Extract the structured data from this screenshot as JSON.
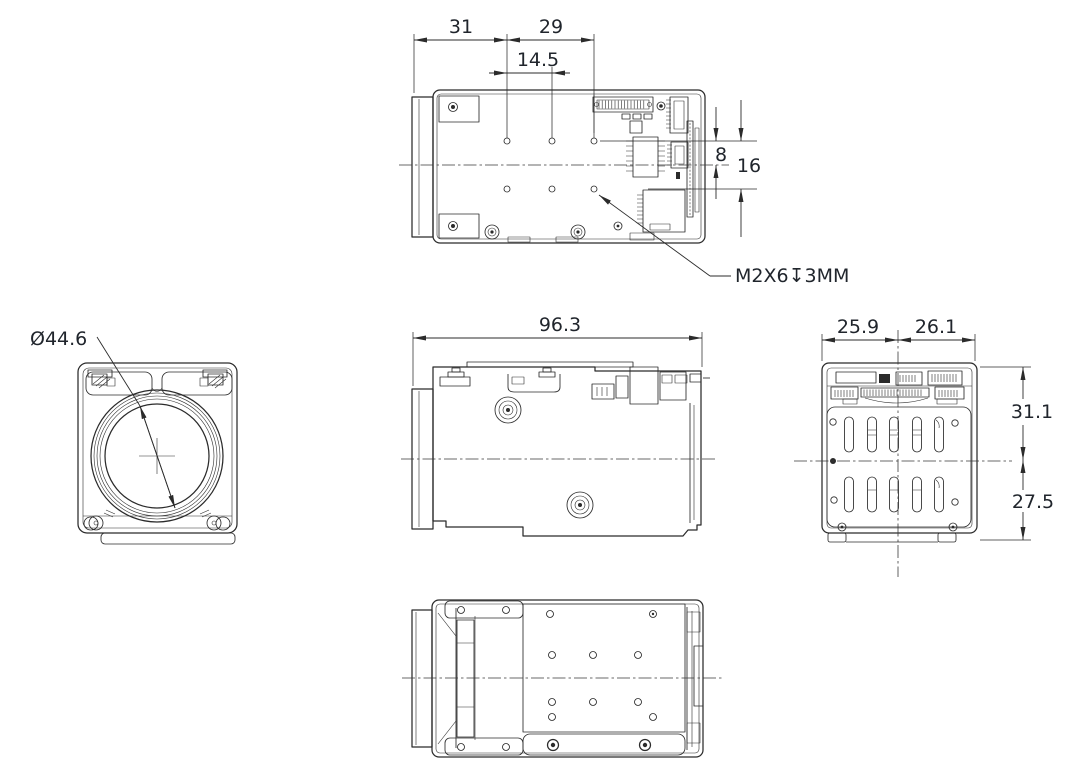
{
  "drawing": {
    "colors": {
      "background": "#ffffff",
      "line": "#2b2b2b",
      "text": "#20252c",
      "centerline": "#3a3a3a"
    },
    "dimensions": {
      "top_view": {
        "lens_front_to_hole_col1": "31",
        "hole_col1_to_col3": "29",
        "hole_pitch": "14.5",
        "hole_row_to_centerline": "8",
        "hole_row_spacing": "16",
        "thread_callout": "M2X6↧3MM"
      },
      "front_view": {
        "lens_diameter": "Ø44.6"
      },
      "side_view": {
        "overall_length": "96.3"
      },
      "rear_view": {
        "width_left_of_center": "25.9",
        "width_right_of_center": "26.1",
        "height_above_center": "31.1",
        "height_below_center": "27.5"
      }
    }
  }
}
